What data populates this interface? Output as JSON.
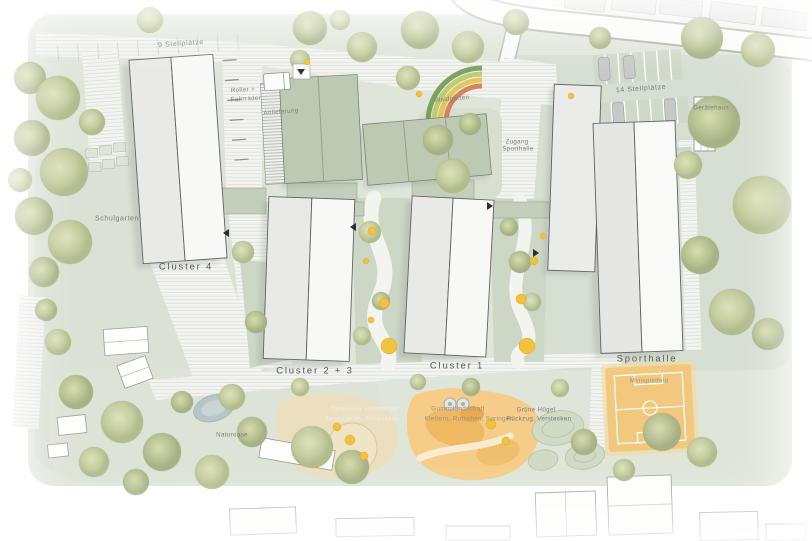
{
  "plan_labels": {
    "stellplaetze_9": "9 Stellplätze",
    "anlieferung": "Anlieferung",
    "roller_line1": "Roller +",
    "roller_line2": "Fahrräder",
    "waldgarten": "Waldgarten",
    "stellplaetze_14": "14 Stellplätze",
    "geraetehaus": "Gerätehaus",
    "zugang_line1": "Zugang",
    "zugang_line2": "Sporthalle",
    "schulgarten": "Schulgarten",
    "cluster_4": "Cluster 4",
    "cluster_2_3": "Cluster 2 + 3",
    "cluster_1": "Cluster 1",
    "sporthalle": "Sporthalle",
    "minispielfeld": "Minispielfeld",
    "naturoase": "Naturoase",
    "spielhuette_line1": "Spielhütte Holzhäusel",
    "spielhuette_line2": "Balancieren, Schaukeln",
    "gummi_line1": "Gummilandschaft",
    "gummi_line2": "Klettern, Rutschen, Springen",
    "gruene_line1": "Grüne Hügel",
    "gruene_line2": "Rückzug, Verstecken"
  },
  "icons": {
    "entrance_arrow_icon": "▼"
  },
  "colors": {
    "site_green": "#e0e5da",
    "zone_green_dark": "#d5ddd0",
    "roof_green": "#bdc9b2",
    "lawn_green": "#cdd7c6",
    "building_white": "#f8f8f6",
    "building_grey": "#e9eae8",
    "path_light": "#f3f4f0",
    "road_white": "#fafaf8",
    "orange_field": "#f2c87e",
    "play_orange": "#f5cd88",
    "sand": "#ebdfbf",
    "pond_blue": "#b6c5c6",
    "accent_yellow": "#f2c23e",
    "label_grey": "#787d78",
    "label_dark": "#54575a"
  }
}
